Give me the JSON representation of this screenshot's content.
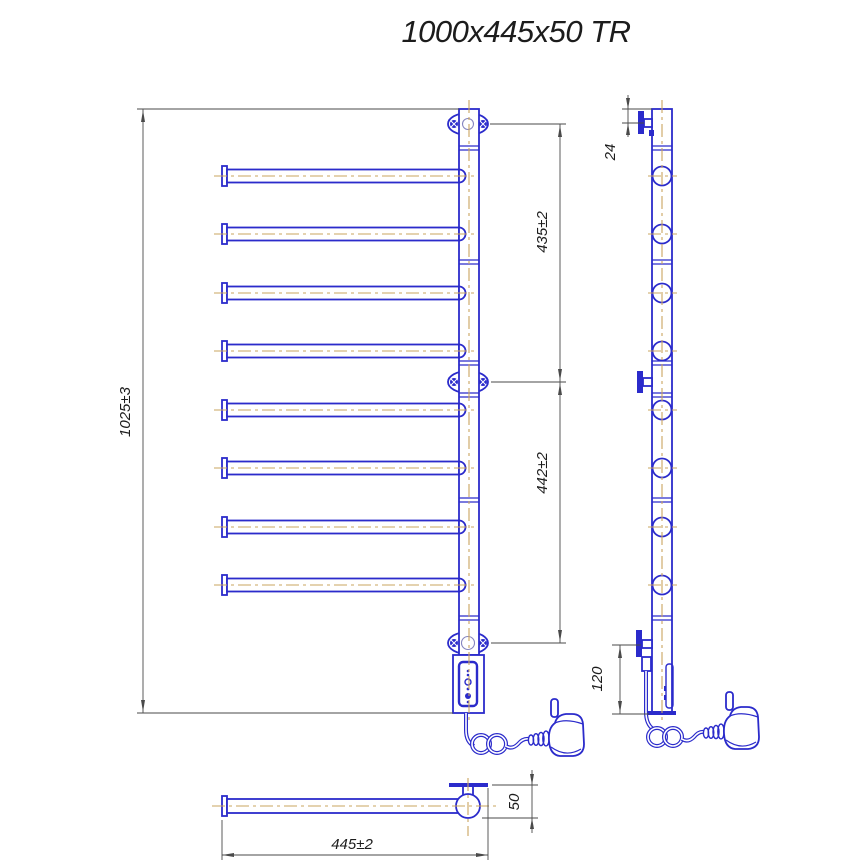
{
  "title": "1000x445x50 TR",
  "dimensions": {
    "overall_height": "1025±3",
    "upper_span": "435±2",
    "lower_span": "442±2",
    "top_bracket_offset": "24",
    "bottom_bracket_offset": "120",
    "overall_width": "445±2",
    "depth": "50"
  },
  "colors": {
    "line": "#2b2bcb",
    "centerline": "#c9a45f",
    "dimension_line": "#4a4a4a",
    "text": "#1c1c1c",
    "background": "#ffffff"
  }
}
